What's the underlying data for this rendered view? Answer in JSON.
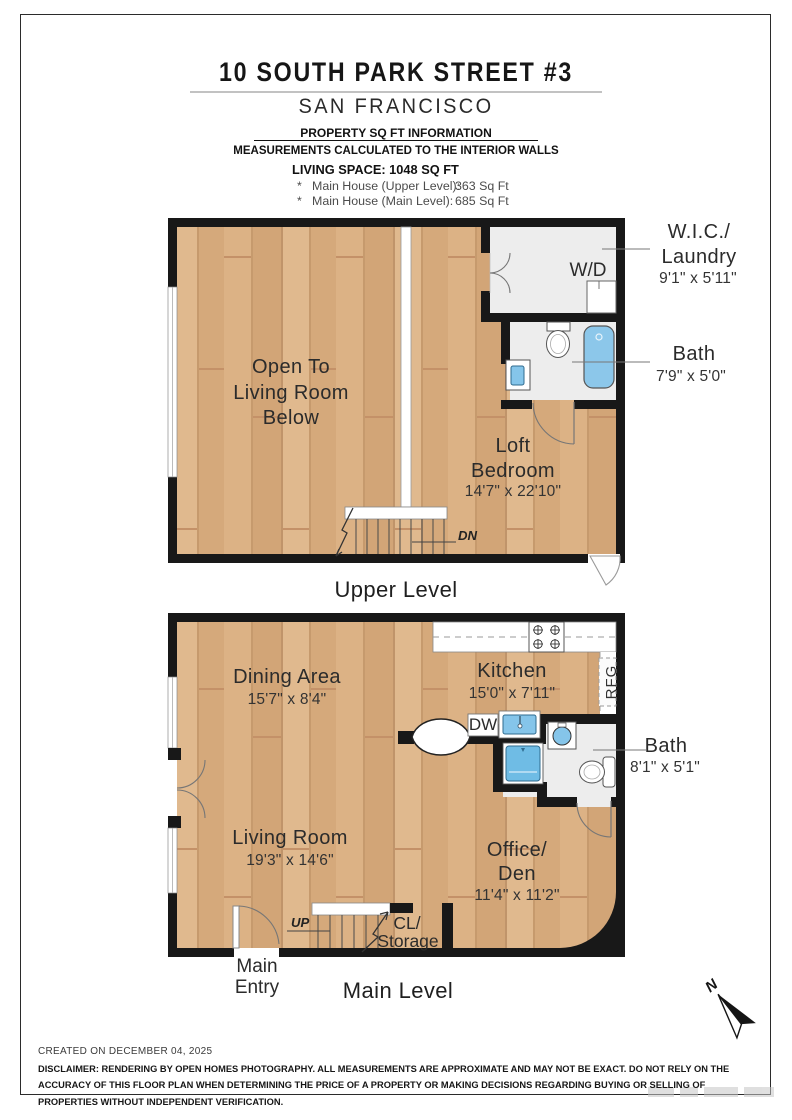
{
  "header": {
    "title": "10 SOUTH PARK STREET #3",
    "city": "SAN FRANCISCO",
    "info_title": "PROPERTY SQ FT INFORMATION",
    "info_note": "MEASUREMENTS CALCULATED TO THE INTERIOR WALLS",
    "living_space": "LIVING SPACE: 1048 SQ FT",
    "items": [
      {
        "bullet": "*",
        "label": "Main House (Upper Level):",
        "value": "363 Sq Ft"
      },
      {
        "bullet": "*",
        "label": "Main House (Main Level):",
        "value": "685 Sq Ft"
      }
    ]
  },
  "upper_level": {
    "caption": "Upper Level",
    "open_to": {
      "line1": "Open To",
      "line2": "Living Room",
      "line3": "Below"
    },
    "loft": {
      "line1": "Loft",
      "line2": "Bedroom",
      "dims": "14'7\" x 22'10\""
    },
    "wic": {
      "line1": "W.I.C./",
      "line2": "Laundry",
      "dims": "9'1\" x 5'11\""
    },
    "bath": {
      "name": "Bath",
      "dims": "7'9\" x 5'0\""
    },
    "labels": {
      "wd": "W/D",
      "dn": "DN"
    }
  },
  "main_level": {
    "caption": "Main Level",
    "dining": {
      "name": "Dining Area",
      "dims": "15'7\" x 8'4\""
    },
    "kitchen": {
      "name": "Kitchen",
      "dims": "15'0\" x 7'11\""
    },
    "living": {
      "name": "Living Room",
      "dims": "19'3\" x 14'6\""
    },
    "office": {
      "line1": "Office/",
      "line2": "Den",
      "dims": "11'4\" x 11'2\""
    },
    "bath": {
      "name": "Bath",
      "dims": "8'1\" x 5'1\""
    },
    "closet": {
      "line1": "CL/",
      "line2": "Storage"
    },
    "entry": {
      "line1": "Main",
      "line2": "Entry"
    },
    "labels": {
      "rfg": "RFG",
      "dw": "DW",
      "up": "UP"
    }
  },
  "compass": {
    "label": "N"
  },
  "footer": {
    "created": "CREATED ON DECEMBER 04, 2025",
    "disclaimer": "DISCLAIMER: RENDERING BY OPEN HOMES PHOTOGRAPHY. ALL MEASUREMENTS ARE APPROXIMATE AND MAY NOT BE EXACT. DO NOT RELY ON THE ACCURACY OF THIS FLOOR PLAN WHEN DETERMINING THE PRICE OF A PROPERTY OR MAKING DECISIONS REGARDING BUYING OR SELLING OF PROPERTIES WITHOUT INDEPENDENT VERIFICATION."
  },
  "colors": {
    "wall": "#181818",
    "wood": "#d9ad7e",
    "tile": "#ededed",
    "fixture_blue": "#85c5ea"
  }
}
